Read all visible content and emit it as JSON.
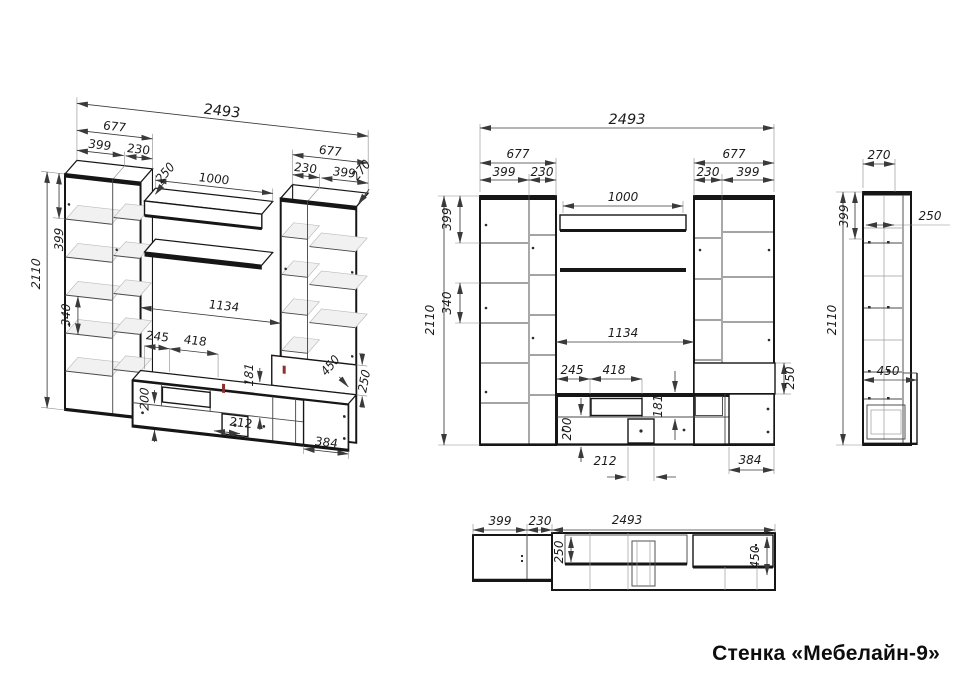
{
  "title": {
    "label": "Стенка «Мебелайн-9»"
  },
  "views": {
    "axon": {
      "dims": {
        "overall_width": "2493",
        "left_width": "677",
        "left_col_a": "399",
        "left_col_b": "230",
        "shelf_depth": "250",
        "shelf_width": "1000",
        "right_width": "677",
        "right_col_a": "230",
        "right_col_b": "399",
        "cabinet_depth": "270",
        "top_section_h": "399",
        "mid_section_h": "340",
        "height": "2110",
        "niche_width": "1134",
        "comp_a": "245",
        "comp_b": "418",
        "upper_row_h": "181",
        "lower_row_h": "200",
        "drawer_w": "212",
        "right_base_w": "384",
        "right_shelf_h": "250",
        "base_depth": "450"
      }
    },
    "front": {
      "dims": {
        "overall_width": "2493",
        "left_width": "677",
        "left_col_a": "399",
        "left_col_b": "230",
        "shelf_width": "1000",
        "right_width": "677",
        "right_col_a": "230",
        "right_col_b": "399",
        "top_section_h": "399",
        "mid_section_h": "340",
        "height": "2110",
        "niche_width": "1134",
        "comp_a": "245",
        "comp_b": "418",
        "upper_row_h": "181",
        "lower_row_h": "200",
        "drawer_w": "212",
        "right_base_w": "384",
        "right_shelf_h": "250"
      }
    },
    "side": {
      "dims": {
        "depth": "270",
        "top_section_h": "399",
        "shelf_depth": "250",
        "height": "2110",
        "base_depth": "450"
      }
    },
    "plan": {
      "dims": {
        "col_a": "399",
        "col_b": "230",
        "overall_width": "2493",
        "shelf_depth": "250",
        "base_depth": "450"
      }
    }
  }
}
